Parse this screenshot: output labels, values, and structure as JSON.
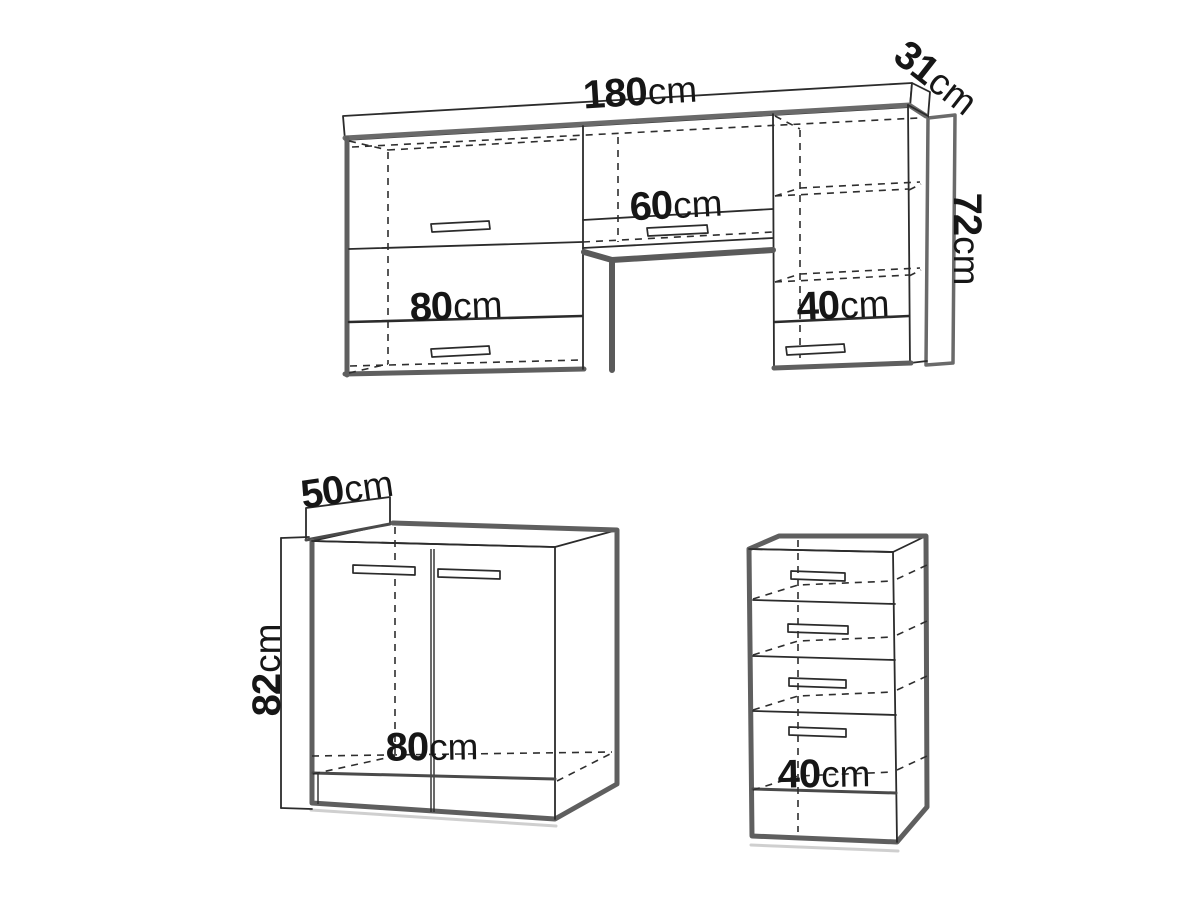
{
  "diagram": {
    "background": "#ffffff",
    "line_color": "#2b2b2b",
    "outline_color": "#5f5f5f",
    "accent_gray": "#6a6a6a",
    "text_color": "#161616"
  },
  "dimensions": {
    "desk": {
      "width": {
        "num": "180",
        "unit": "cm"
      },
      "depth": {
        "num": "31",
        "unit": "cm"
      },
      "height": {
        "num": "72",
        "unit": "cm"
      },
      "middle_width": {
        "num": "60",
        "unit": "cm"
      },
      "left_pedestal_width": {
        "num": "80",
        "unit": "cm"
      },
      "right_pedestal_width": {
        "num": "40",
        "unit": "cm"
      }
    },
    "base_cabinet": {
      "depth": {
        "num": "50",
        "unit": "cm"
      },
      "height": {
        "num": "82",
        "unit": "cm"
      },
      "width": {
        "num": "80",
        "unit": "cm"
      }
    },
    "drawer_unit": {
      "width": {
        "num": "40",
        "unit": "cm"
      }
    }
  }
}
